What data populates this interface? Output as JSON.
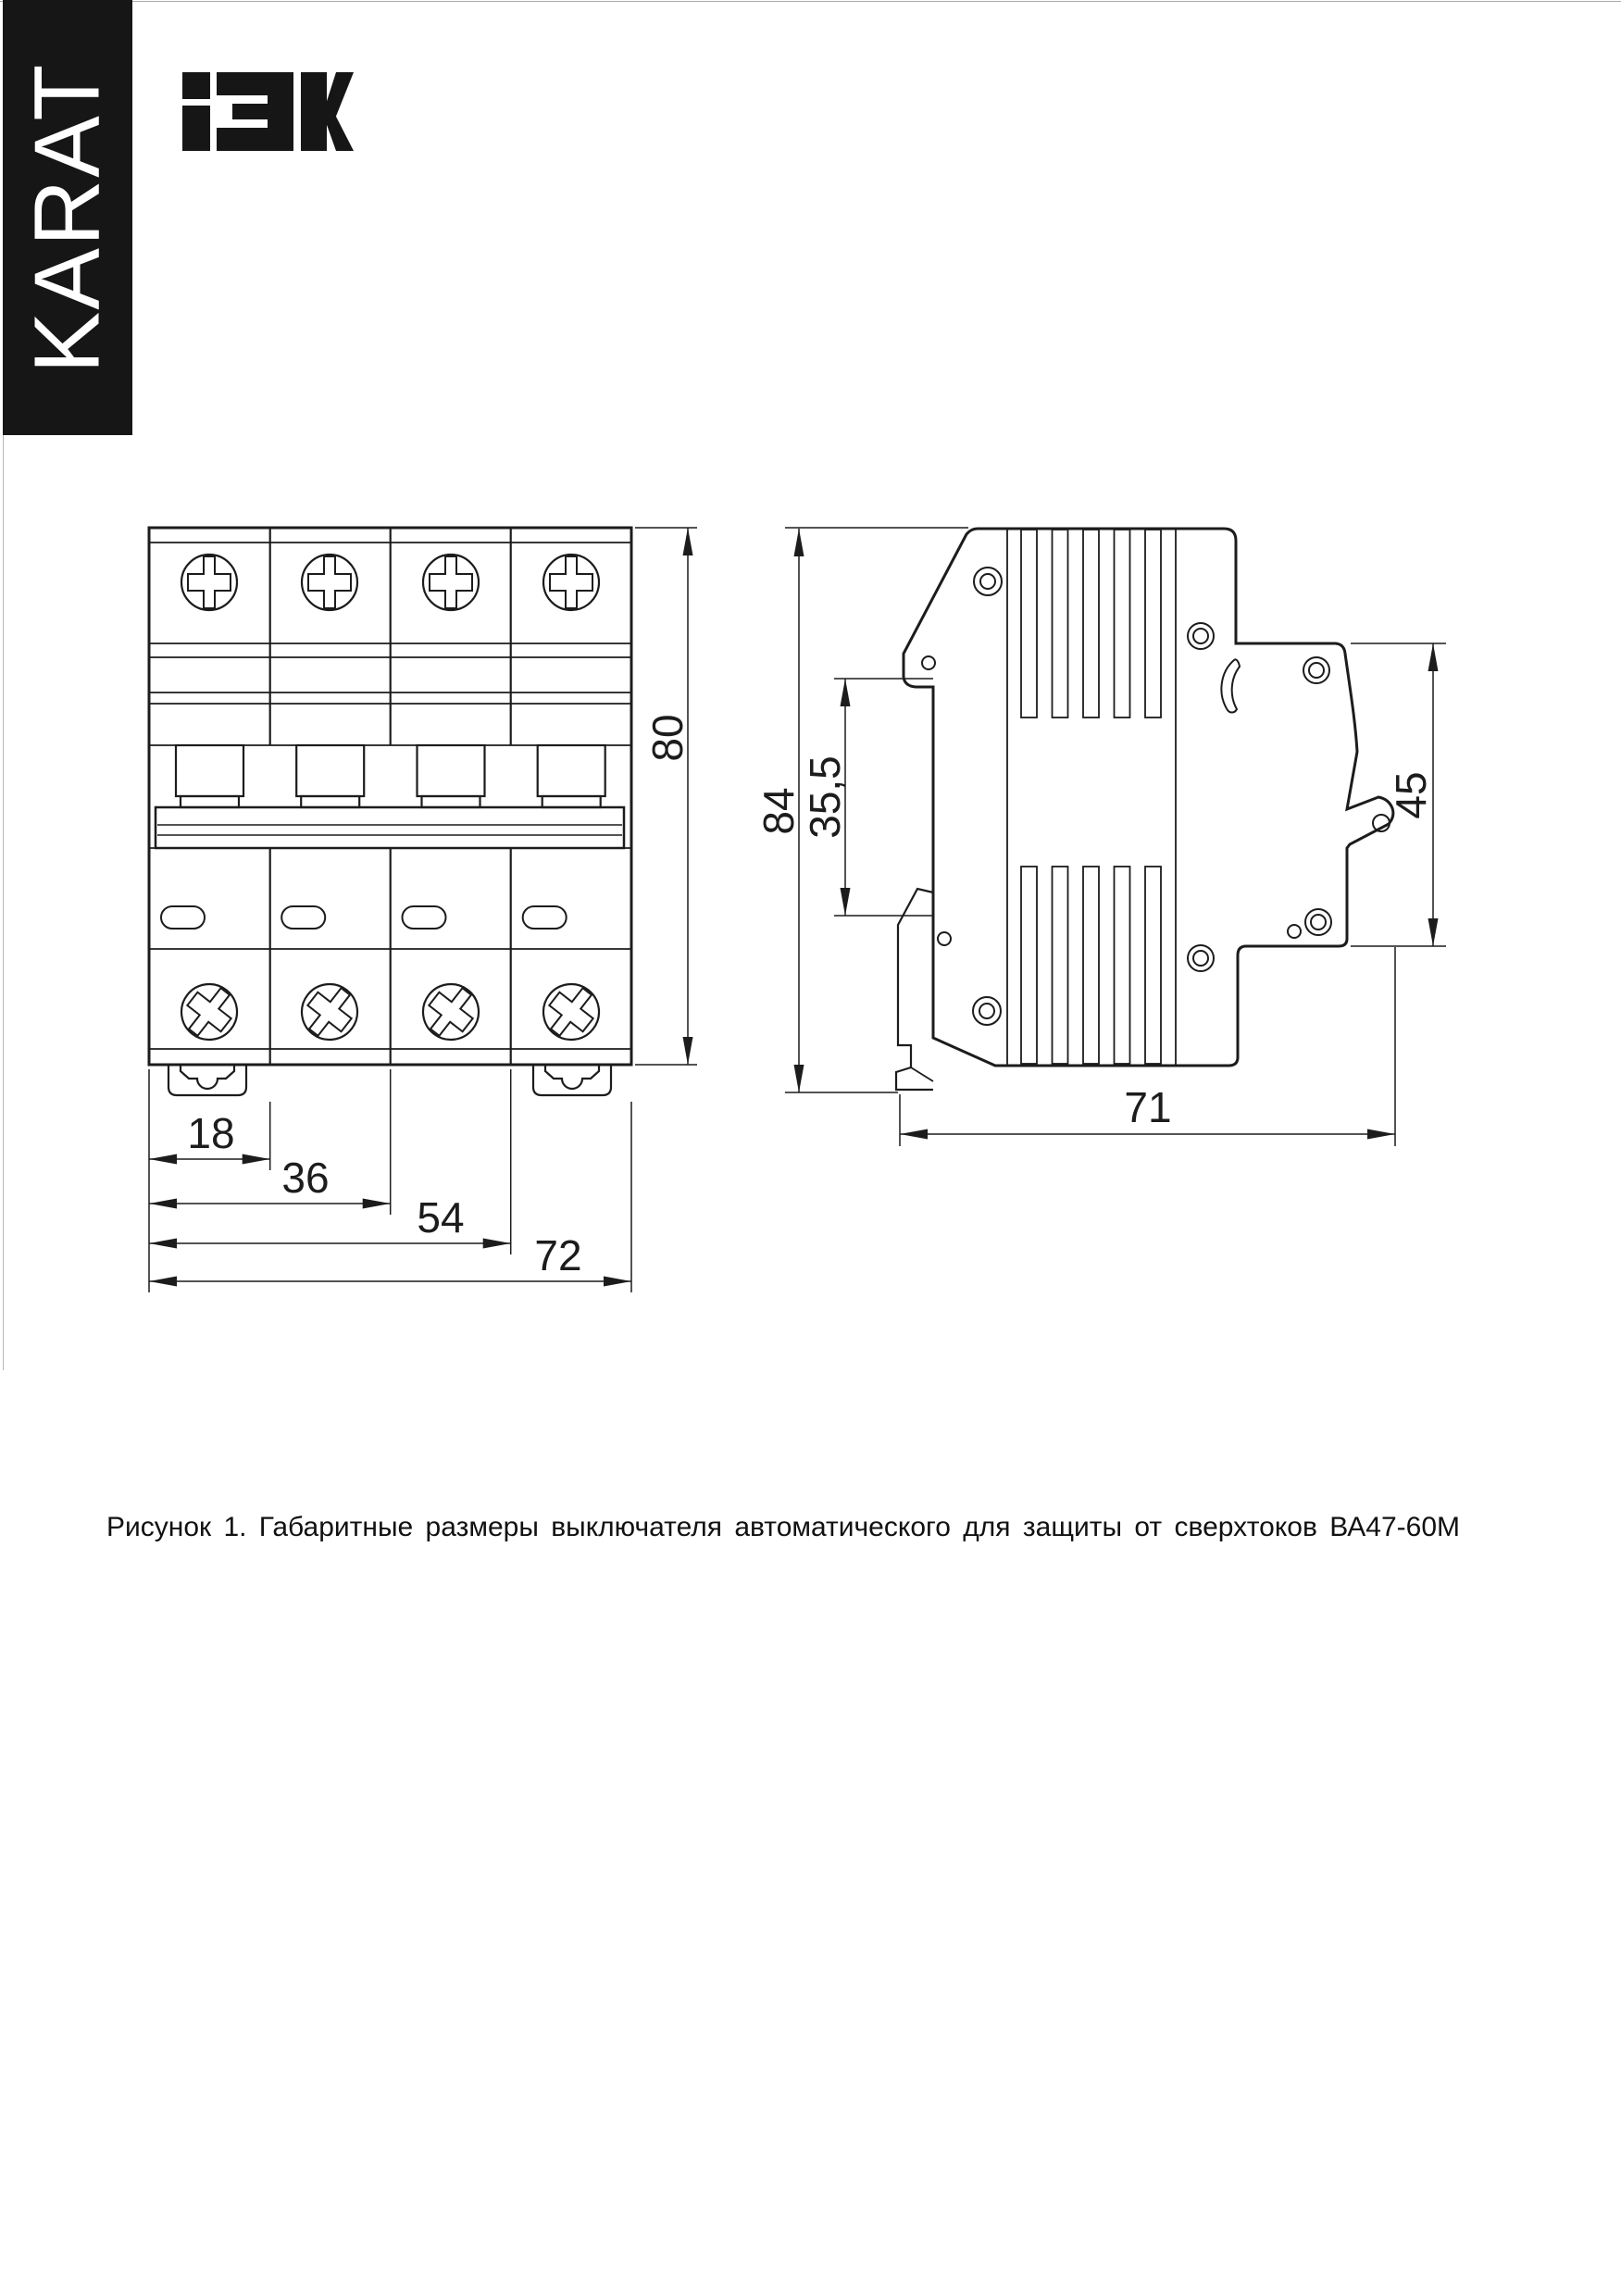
{
  "brand": {
    "karat": "KARAT",
    "iek": "IEK"
  },
  "caption": {
    "text": "Рисунок 1. Габаритные размеры выключателя автоматического для защиты от сверхтоков ВА47-60М"
  },
  "figure": {
    "number": "1",
    "product": "ВА47-60М"
  },
  "front_view": {
    "dim_height": "80",
    "dim_module1": "18",
    "dim_module2": "36",
    "dim_module3": "54",
    "dim_total_width": "72"
  },
  "side_view": {
    "dim_height": "84",
    "dim_rail_window": "35,5",
    "dim_front_face": "45",
    "dim_depth": "71"
  },
  "colors": {
    "ink": "#1c1c1c",
    "paper": "#ffffff",
    "banner": "#161616"
  }
}
